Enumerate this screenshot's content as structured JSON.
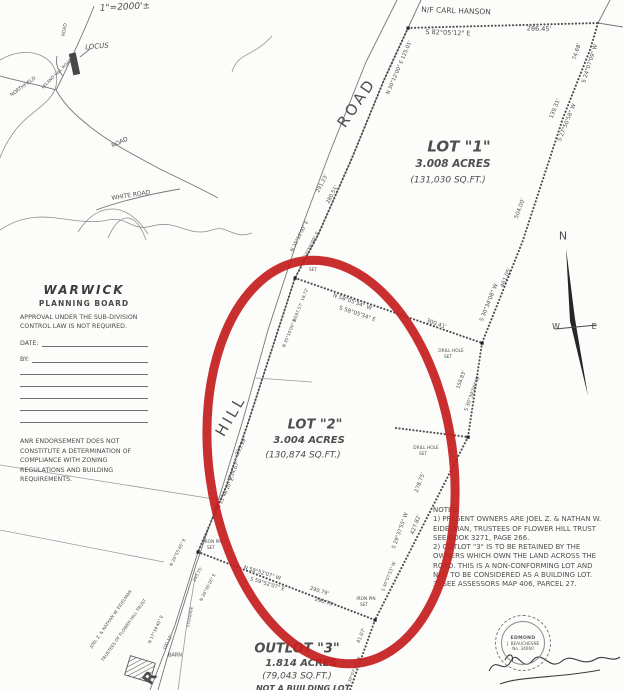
{
  "document": {
    "kind": "scanned survey plat",
    "town": "WARWICK"
  },
  "colors": {
    "paper": "#fcfcfa",
    "ink": "#4a4a4a",
    "annotation_red": "#c51f1f"
  },
  "planning_board": {
    "title": "WARWICK",
    "subtitle": "PLANNING BOARD",
    "approval_text": "APPROVAL UNDER THE SUB-DIVISION CONTROL LAW IS NOT REQUIRED.",
    "date_label": "DATE:",
    "by_label": "BY:",
    "anr_text": "ANR ENDORSEMENT DOES NOT CONSTITUTE A DETERMINATION OF COMPLIANCE WITH ZONING REGULATIONS AND BUILDING REQUIREMENTS."
  },
  "notes": {
    "lines": [
      "NOTES:",
      "1) PRESENT OWNERS ARE JOEL Z. & NATHAN W.",
      "EIDELMAN, TRUSTEES OF FLOWER HILL TRUST",
      "SEE BOOK 3271, PAGE 266.",
      "2) OUTLOT \"3\" IS TO BE RETAINED BY THE",
      "OWNERS WHICH OWN THE LAND ACROSS THE",
      "ROAD. THIS IS A NON-CONFORMING LOT AND",
      "NOT TO BE CONSIDERED AS A BUILDING LOT.",
      "3) SEE ASSESSORS MAP 406, PARCEL 27."
    ]
  },
  "stamp": {
    "line1": "EDMOND",
    "line2": "J. BEAUCHESNE",
    "line3": "No. 34660"
  },
  "plat": {
    "labels": [
      {
        "n": "scale-note",
        "t": "1\"=2000'±",
        "x": 125,
        "y": 8,
        "r": -3,
        "s": 9,
        "i": 1
      },
      {
        "n": "locus-label",
        "t": "LOCUS",
        "x": 97,
        "y": 47,
        "r": -5,
        "s": 7,
        "i": 1
      },
      {
        "n": "locus-road-north",
        "t": "ROAD",
        "x": 66,
        "y": 30,
        "r": -80,
        "s": 4.5
      },
      {
        "n": "locus-leland-hill-road",
        "t": "LELAND HILL ROAD",
        "x": 57,
        "y": 74,
        "r": -44,
        "s": 4.2
      },
      {
        "n": "locus-northfield",
        "t": "NORTHFIELD",
        "x": 24,
        "y": 88,
        "r": -36,
        "s": 4.8
      },
      {
        "n": "locus-road-mid",
        "t": "ROAD",
        "x": 120,
        "y": 143,
        "r": -26,
        "s": 6
      },
      {
        "n": "locus-white-road",
        "t": "WHITE ROAD",
        "x": 131,
        "y": 196,
        "r": -9,
        "s": 6
      },
      {
        "n": "abutter-north",
        "t": "N/F CARL HANSON",
        "x": 456,
        "y": 11,
        "r": 2,
        "s": 7.5
      },
      {
        "n": "bearing-north-line",
        "t": "S 82°05'12\" E",
        "x": 448,
        "y": 33,
        "r": 2,
        "s": 6.5
      },
      {
        "n": "dist-north-line",
        "t": "286.45'",
        "x": 539,
        "y": 29,
        "r": 2,
        "s": 6.5
      },
      {
        "n": "dist-ne-1",
        "t": "74.68'",
        "x": 578,
        "y": 52,
        "r": -72,
        "s": 5.5
      },
      {
        "n": "bearing-ne-1",
        "t": "S 24°07'09\" W",
        "x": 591,
        "y": 64,
        "r": -72,
        "s": 5.5
      },
      {
        "n": "dist-ne-2",
        "t": "139.31'",
        "x": 556,
        "y": 109,
        "r": -68,
        "s": 5.5
      },
      {
        "n": "bearing-ne-2",
        "t": "S 27°50'58\" W",
        "x": 568,
        "y": 123,
        "r": -68,
        "s": 5.5
      },
      {
        "n": "dist-east-1",
        "t": "504.00'",
        "x": 521,
        "y": 209,
        "r": -70,
        "s": 5.5
      },
      {
        "n": "dist-east-2",
        "t": "461.05'",
        "x": 507,
        "y": 278,
        "r": -68,
        "s": 5.5
      },
      {
        "n": "bearing-east-1",
        "t": "S 30°34'08\" W",
        "x": 490,
        "y": 303,
        "r": -68,
        "s": 5.5
      },
      {
        "n": "lot1-title",
        "t": "LOT \"1\"",
        "x": 459,
        "y": 147,
        "s": 15,
        "b": 1,
        "i": 1
      },
      {
        "n": "lot1-acres",
        "t": "3.008 ACRES",
        "x": 453,
        "y": 164,
        "s": 10.5,
        "b": 1,
        "i": 1
      },
      {
        "n": "lot1-sqft",
        "t": "(131,030 SQ.FT.)",
        "x": 448,
        "y": 181,
        "s": 9,
        "i": 1
      },
      {
        "n": "road-name",
        "t": "ROAD",
        "x": 357,
        "y": 103,
        "r": -56,
        "s": 15,
        "ls": 3
      },
      {
        "n": "bearing-road-top",
        "t": "N 30°12'00\" E 125.01'",
        "x": 400,
        "y": 68,
        "r": -67,
        "s": 5.2
      },
      {
        "n": "dist-wall-1",
        "t": "291.23'",
        "x": 323,
        "y": 184,
        "r": -63,
        "s": 5.2
      },
      {
        "n": "dist-wall-2",
        "t": "280.51'",
        "x": 333,
        "y": 195,
        "r": -63,
        "s": 5.2
      },
      {
        "n": "bearing-wall-1",
        "t": "N 35°10'00\" E",
        "x": 301,
        "y": 237,
        "r": -63,
        "s": 4.8
      },
      {
        "n": "bearing-wall-2",
        "t": "N 33°59'00\" E",
        "x": 312,
        "y": 248,
        "r": -63,
        "s": 4.8
      },
      {
        "n": "iron-pin-1-label",
        "t": "IRON PIN",
        "x": 316,
        "y": 265,
        "s": 4.3
      },
      {
        "n": "iron-pin-1-set",
        "t": "SET",
        "x": 313,
        "y": 271,
        "s": 4.3
      },
      {
        "n": "dist-road-2",
        "t": "18.72'",
        "x": 306,
        "y": 295,
        "r": -68,
        "s": 4.3
      },
      {
        "n": "dist-road-3",
        "t": "E 187.57'",
        "x": 299,
        "y": 313,
        "r": -68,
        "s": 4.3
      },
      {
        "n": "bearing-road-2",
        "t": "N 35°10'00\" W",
        "x": 291,
        "y": 333,
        "r": -68,
        "s": 4.3
      },
      {
        "n": "bearing-div-1",
        "t": "N 58°05'34\" W",
        "x": 352,
        "y": 303,
        "r": 19,
        "s": 5.5
      },
      {
        "n": "bearing-div-2",
        "t": "S 58°05'34\" E",
        "x": 357,
        "y": 315,
        "r": 19,
        "s": 5.5
      },
      {
        "n": "dist-div",
        "t": "300.41'",
        "x": 436,
        "y": 325,
        "r": 19,
        "s": 5.5
      },
      {
        "n": "drill-hole-1-label",
        "t": "DRILL HOLE",
        "x": 451,
        "y": 352,
        "s": 4.3
      },
      {
        "n": "drill-hole-1-set",
        "t": "SET",
        "x": 448,
        "y": 358,
        "s": 4.3
      },
      {
        "n": "dist-east-3",
        "t": "158.83'",
        "x": 462,
        "y": 380,
        "r": -70,
        "s": 5
      },
      {
        "n": "bearing-east-2",
        "t": "S 30°34'06\" W",
        "x": 473,
        "y": 394,
        "r": -70,
        "s": 5
      },
      {
        "n": "lot2-title",
        "t": "LOT \"2\"",
        "x": 315,
        "y": 425,
        "s": 13,
        "b": 1,
        "i": 1
      },
      {
        "n": "lot2-acres",
        "t": "3.004 ACRES",
        "x": 309,
        "y": 441,
        "s": 10,
        "b": 1,
        "i": 1
      },
      {
        "n": "lot2-sqft",
        "t": "(130,874 SQ.FT.)",
        "x": 303,
        "y": 456,
        "s": 9,
        "i": 1
      },
      {
        "n": "drill-hole-2-label",
        "t": "DRILL HOLE",
        "x": 426,
        "y": 449,
        "s": 4.3
      },
      {
        "n": "drill-hole-2-set",
        "t": "SET",
        "x": 423,
        "y": 455,
        "s": 4.3
      },
      {
        "n": "dist-se-1",
        "t": "278.75'",
        "x": 421,
        "y": 483,
        "r": -70,
        "s": 5.5
      },
      {
        "n": "dist-se-2",
        "t": "427.82'",
        "x": 417,
        "y": 525,
        "r": -70,
        "s": 5.5
      },
      {
        "n": "bearing-se-1",
        "t": "S 29°37'55\" W",
        "x": 401,
        "y": 531,
        "r": -70,
        "s": 5.2
      },
      {
        "n": "hill-name",
        "t": "HILL",
        "x": 231,
        "y": 416,
        "r": -60,
        "s": 15,
        "ls": 3
      },
      {
        "n": "dist-road-4",
        "t": "255.99'",
        "x": 242,
        "y": 447,
        "r": -65,
        "s": 5.2
      },
      {
        "n": "dist-road-5",
        "t": "234.67'",
        "x": 235,
        "y": 471,
        "r": -65,
        "s": 5.2
      },
      {
        "n": "bearing-road-3",
        "t": "N 33°46'10\" E",
        "x": 227,
        "y": 494,
        "r": -65,
        "s": 4.8
      },
      {
        "n": "iron-pin-2-label",
        "t": "IRON PIN",
        "x": 213,
        "y": 543,
        "s": 4.3
      },
      {
        "n": "iron-pin-2-set",
        "t": "SET",
        "x": 211,
        "y": 549,
        "s": 4.3
      },
      {
        "n": "bearing-outlot-1",
        "t": "N 20°55'45\" E",
        "x": 179,
        "y": 553,
        "r": -63,
        "s": 4.3
      },
      {
        "n": "dist-outlot-1",
        "t": "103.75'",
        "x": 199,
        "y": 575,
        "r": -63,
        "s": 4.3
      },
      {
        "n": "bearing-outlot-2",
        "t": "N 26°36'26\" E",
        "x": 209,
        "y": 588,
        "r": -63,
        "s": 4.3
      },
      {
        "n": "stockade-label",
        "t": "STOCKADE",
        "x": 190,
        "y": 617,
        "r": -79,
        "s": 3.8
      },
      {
        "n": "bearing-outlot-3",
        "t": "N 17°34'40\" E",
        "x": 157,
        "y": 630,
        "r": -65,
        "s": 4.3
      },
      {
        "n": "dist-outlot-2",
        "t": "100.12'",
        "x": 169,
        "y": 643,
        "r": -65,
        "s": 4.3
      },
      {
        "n": "barn-label",
        "t": "BARN",
        "x": 175,
        "y": 656,
        "s": 5
      },
      {
        "n": "road-letter-r",
        "t": "R",
        "x": 150,
        "y": 678,
        "r": -55,
        "s": 16,
        "b": 1
      },
      {
        "n": "owner-line-1",
        "t": "JOEL Z. & NATHAN W. EIDELMAN",
        "x": 112,
        "y": 620,
        "r": -55,
        "s": 4.3
      },
      {
        "n": "owner-line-2",
        "t": "TRUSTEES OF FLOWER HILL TRUST",
        "x": 125,
        "y": 631,
        "r": -55,
        "s": 4.3
      },
      {
        "n": "bearing-bot-1",
        "t": "N 59°52'07\" W",
        "x": 262,
        "y": 574,
        "r": 17,
        "s": 5.2
      },
      {
        "n": "bearing-bot-2",
        "t": "S 59°52'07\" E",
        "x": 267,
        "y": 585,
        "r": 17,
        "s": 5.2
      },
      {
        "n": "dist-bot-1",
        "t": "290.79'",
        "x": 319,
        "y": 592,
        "r": 17,
        "s": 5.2
      },
      {
        "n": "dist-bot-2",
        "t": "290.79'",
        "x": 324,
        "y": 603,
        "r": 17,
        "s": 5.2
      },
      {
        "n": "iron-pin-3-label",
        "t": "IRON PIN",
        "x": 366,
        "y": 600,
        "s": 4.3
      },
      {
        "n": "iron-pin-3-set",
        "t": "SET",
        "x": 364,
        "y": 606,
        "s": 4.3
      },
      {
        "n": "bearing-se-2",
        "t": "S 30°07'53\" W",
        "x": 390,
        "y": 577,
        "r": -68,
        "s": 4.3
      },
      {
        "n": "dist-se-3",
        "t": "41.07'",
        "x": 362,
        "y": 636,
        "r": -68,
        "s": 5
      },
      {
        "n": "bearing-se-3",
        "t": "S 30°07'53\" W",
        "x": 355,
        "y": 672,
        "r": -68,
        "s": 4.3
      },
      {
        "n": "outlot3-title",
        "t": "OUTLOT \"3\"",
        "x": 297,
        "y": 649,
        "s": 13,
        "b": 1,
        "i": 1
      },
      {
        "n": "outlot3-acres",
        "t": "1.814 ACRES",
        "x": 301,
        "y": 664,
        "s": 10,
        "b": 1,
        "i": 1
      },
      {
        "n": "outlot3-sqft",
        "t": "(79,043 SQ.FT.)",
        "x": 297,
        "y": 677,
        "s": 9,
        "i": 1
      },
      {
        "n": "outlot3-note",
        "t": "NOT A BUILDING LOT",
        "x": 303,
        "y": 689,
        "s": 8,
        "b": 1,
        "i": 1
      },
      {
        "n": "compass-n",
        "t": "N",
        "x": 563,
        "y": 236,
        "s": 11
      },
      {
        "n": "compass-w",
        "t": "W",
        "x": 556,
        "y": 327,
        "s": 8
      },
      {
        "n": "compass-e",
        "t": "E",
        "x": 594,
        "y": 327,
        "s": 8
      }
    ]
  }
}
